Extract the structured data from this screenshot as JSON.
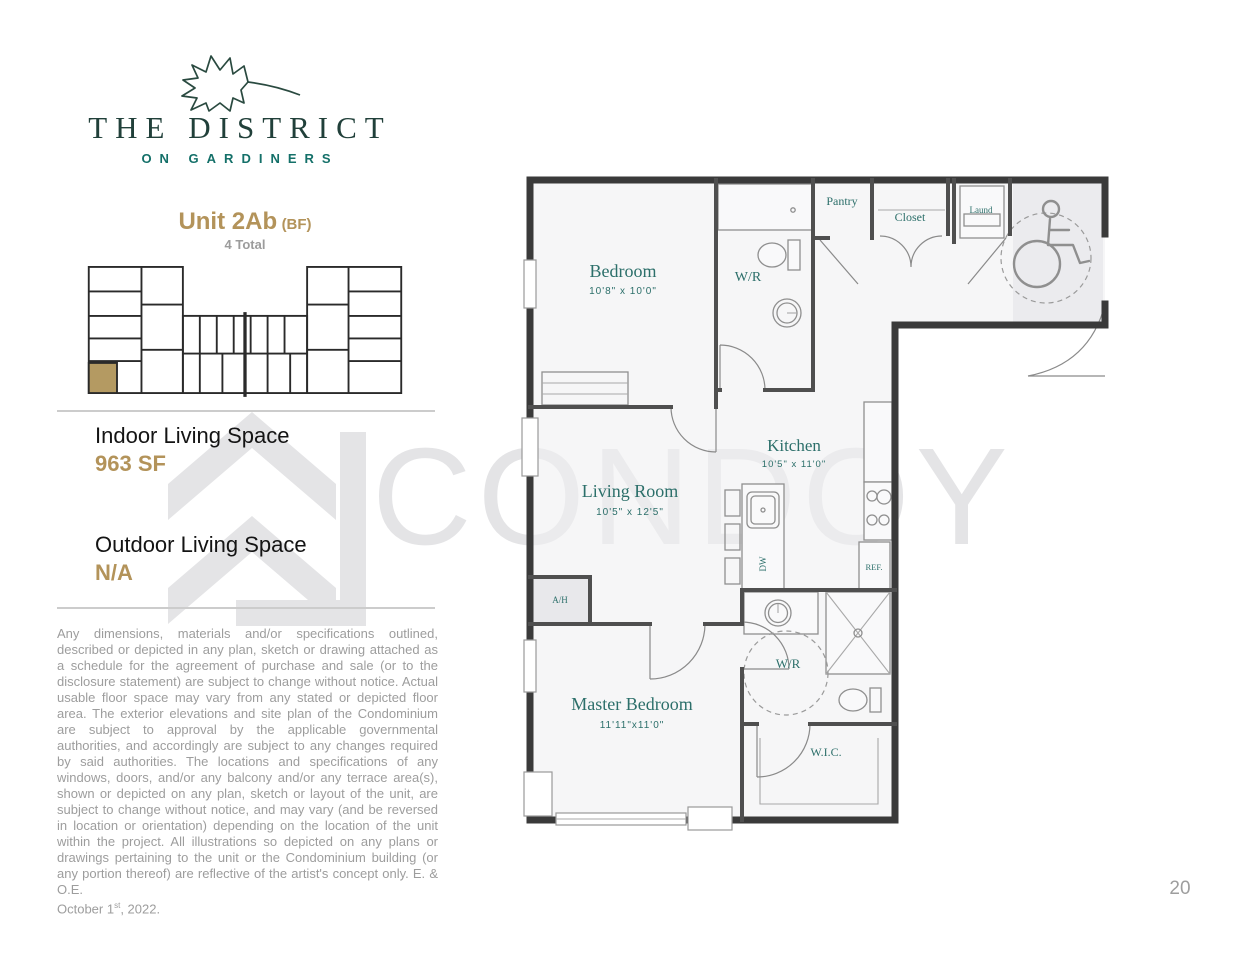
{
  "brand": {
    "name_line1": "THE DISTRICT",
    "name_line2": "ON GARDINERS"
  },
  "unit": {
    "title": "Unit 2Ab",
    "suffix": "(BF)",
    "count": "4 Total"
  },
  "stats": {
    "indoor_label": "Indoor Living Space",
    "indoor_value": "963 SF",
    "outdoor_label": "Outdoor Living Space",
    "outdoor_value": "N/A"
  },
  "disclaimer": {
    "body": "Any dimensions, materials and/or specifications outlined, described or depicted in any plan, sketch or drawing attached as a schedule for the agreement of purchase and sale (or to the disclosure statement) are subject to change without notice. Actual usable floor space may vary from any stated or depicted floor area. The exterior elevations and site plan of the Condominium are subject to approval by the applicable governmental authorities, and accordingly are subject to any changes required by said authorities. The locations and specifications of any windows, doors, and/or any balcony and/or any terrace area(s), shown or depicted on any plan, sketch or layout of the unit, are subject to change without notice, and may vary (and be reversed in location or orientation) depending on the location of the unit within the project. All illustrations so depicted on any plans or drawings pertaining to the unit or the Condominium building (or any portion thereof) are reflective of the artist's concept only. E. & O.E.",
    "date_prefix": "October 1",
    "date_sup": "st",
    "date_suffix": ", 2022."
  },
  "watermark": {
    "text": "CONDOY"
  },
  "page_number": "20",
  "colors": {
    "accent_gold": "#b3935a",
    "room_label_teal": "#2c6f6a",
    "brand_green": "#21403a",
    "brand_teal": "#147069",
    "watermark_gray": "#e4e4e6",
    "keyplan_highlight": "#b49a62"
  },
  "plan": {
    "rooms": {
      "bedroom": {
        "name": "Bedroom",
        "dims": "10'8\" x 10'0\""
      },
      "wr1": {
        "name": "W/R"
      },
      "pantry": {
        "name": "Pantry"
      },
      "closet": {
        "name": "Closet"
      },
      "laund": {
        "name": "Laund"
      },
      "kitchen": {
        "name": "Kitchen",
        "dims": "10'5\" x 11'0\""
      },
      "living": {
        "name": "Living Room",
        "dims": "10'5\" x 12'5\""
      },
      "master": {
        "name": "Master Bedroom",
        "dims": "11'11\"x11'0\""
      },
      "wr2": {
        "name": "W/R"
      },
      "wic": {
        "name": "W.I.C."
      },
      "ah": {
        "name": "A/H"
      }
    },
    "fixtures": {
      "ref": "REF.",
      "dw": "DW"
    }
  }
}
